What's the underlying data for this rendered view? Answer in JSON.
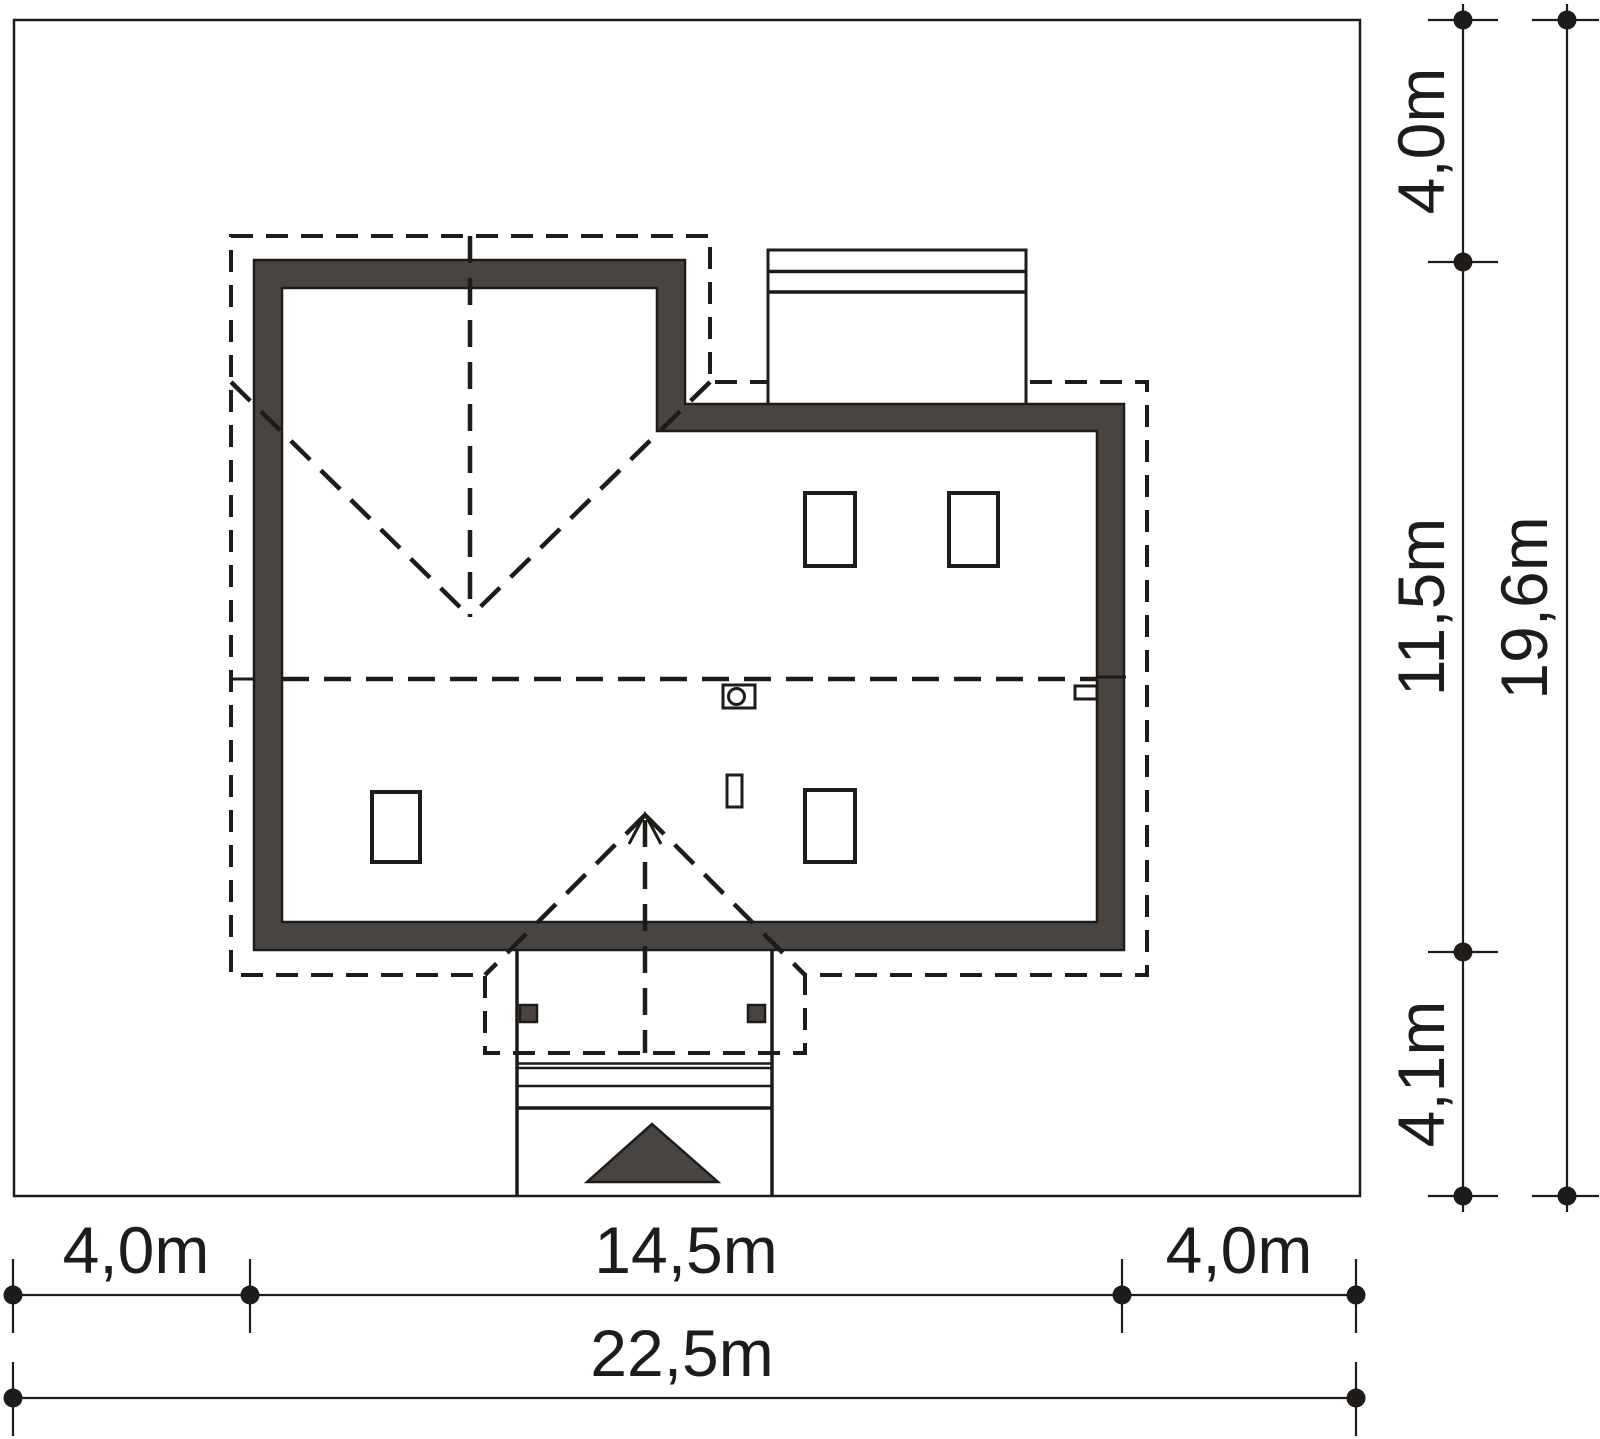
{
  "title": "house-site-plan",
  "dims": {
    "right_top": "4,0m",
    "right_middle": "11,5m",
    "right_bottom": "4,1m",
    "right_total": "19,6m",
    "bottom_left": "4,0m",
    "bottom_middle": "14,5m",
    "bottom_right": "4,0m",
    "bottom_total": "22,5m"
  },
  "colors": {
    "wall_fill": "#4a4440",
    "line": "#1e1b18",
    "background": "#ffffff"
  },
  "symbols": {
    "entrance_arrow": "triangle-up",
    "chimney": "rect-with-circle",
    "vent": "small-rect",
    "roof_edges": "dashed-outline",
    "dimension_tick": "dot-with-crossbar"
  }
}
